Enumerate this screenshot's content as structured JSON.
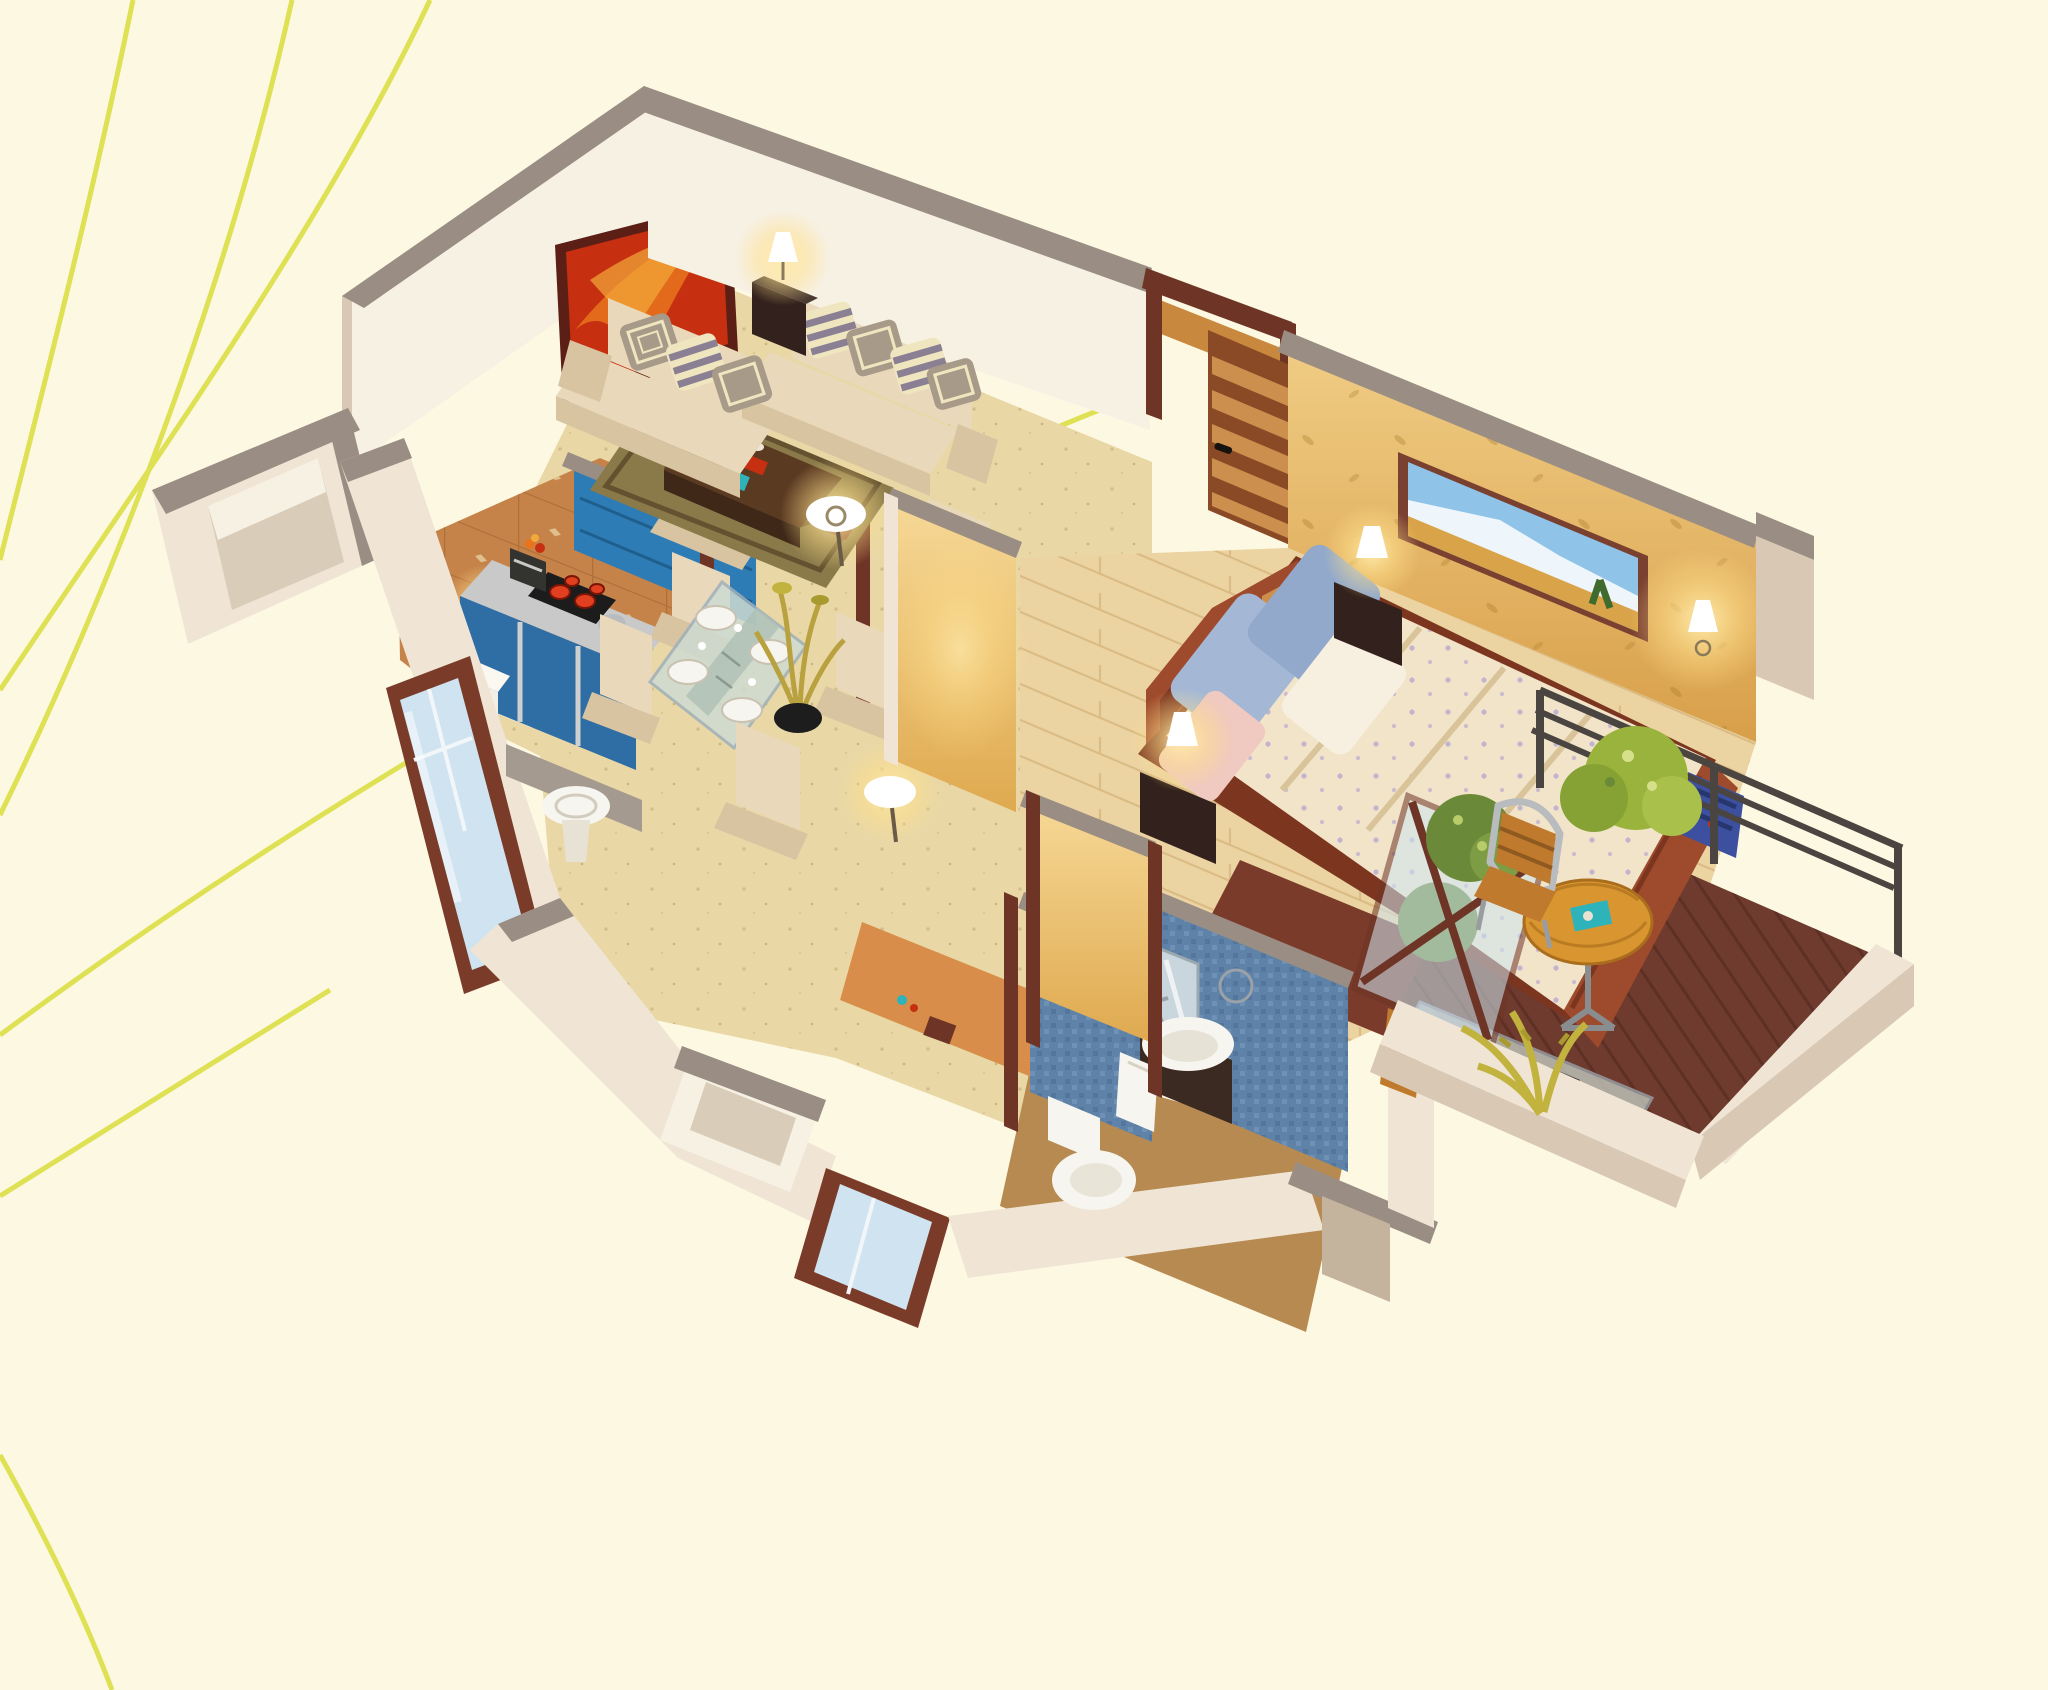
{
  "title": "isometric-1bhk-apartment-cutaway-render",
  "palette": {
    "bg": "#fdf8e2",
    "curve": "#dee153",
    "cap": "#9a8d83",
    "wallLight": "#f0e5d5",
    "wallMid": "#e8dcc8",
    "wallDark": "#d9c9b4",
    "wallInner": "#f7f1e4",
    "floorTravertine": "#e9d8a6",
    "floorKitchen": "#c58349",
    "floorWoodBed": "#ecd3a2",
    "floorBath": "#b78a52",
    "floorBalcony": "#6e3b2e",
    "runnerOrange": "#d88e4a",
    "entryWood": "#c8893f",
    "partitionBlue": "#2e7cb5",
    "cabinetBlue": "#2f6da5",
    "counterSteel": "#c9c9c9",
    "stoveBlack": "#1c1c1c",
    "burnerRed": "#e04020",
    "fridgeWhite": "#f3efe7",
    "windowFrame": "#7a3c28",
    "windowGlass": "#cfe4f0",
    "doorWood": "#8a4a26",
    "doorSlat": "#cd8f4d",
    "frameWood": "#6e3526",
    "sofaCream": "#e9d8ba",
    "sofaShadow": "#d9c4a1",
    "pillowStripe": "#8a7f93",
    "pillowCream": "#efe6c0",
    "pillowTaupe": "#a89a88",
    "rugOlive": "#8a7a4a",
    "rugDark": "#64512f",
    "rugRed": "#7a3b2a",
    "tableWoodTop": "#5b3a22",
    "tableWoodSide": "#3f2817",
    "artRed": "#c62f10",
    "artOrange": "#e8741c",
    "artFrame": "#5c1f16",
    "mtnFrame": "#7a4030",
    "mtnSky": "#8fc4e8",
    "mtnSnow": "#eef6fb",
    "mtnField": "#d9a349",
    "mtnTree": "#3f6b2f",
    "wallYellow": "#e7bb6d",
    "wallYellowDeep": "#dfa94f",
    "bedWood": "#9e4a2c",
    "bedWoodDark": "#7c3620",
    "duvetCream": "#f2e4c9",
    "sheetWhite": "#f7f0e0",
    "pillowBlue": "#a4b8d6",
    "pillowPink": "#f0c9c0",
    "nightstand": "#32211c",
    "lampShade": "#ffffff",
    "mosaicBlue": "#5f83a8",
    "porcelainWhite": "#f7f5ef",
    "vanityDark": "#3a2a22",
    "railMetal": "#4a4540",
    "balconyTable": "#d9952f",
    "chairWood": "#c07a2e",
    "chairSteel": "#b9bcbe",
    "bushGreen": "#6b8a39",
    "bushLight": "#9ab33c",
    "plantYellow": "#c2b23e",
    "backpackBlue": "#3d50a0",
    "glassTint": "#cddbd2",
    "magazineTeal": "#2fb3bb",
    "sillGray": "#a49a90"
  },
  "scene": {
    "type": "isometric-floorplan-render",
    "background_motifs": [
      "curved-line",
      "curved-line",
      "curved-line",
      "curved-line",
      "curved-line",
      "curved-line"
    ],
    "rooms": [
      {
        "name": "living-room",
        "objects": [
          "red-abstract-painting",
          "sofa-three-seat",
          "sofa-two-seat",
          "striped-cushions",
          "corner-lamp-table",
          "table-lamp",
          "coffee-table",
          "magazines",
          "vase",
          "area-rug",
          "armchair",
          "floor-lamp",
          "floor-lamp"
        ]
      },
      {
        "name": "kitchen",
        "objects": [
          "blue-backsplash-partition",
          "wall-disc-lamp",
          "steel-counter",
          "cooktop-four-burners",
          "coffee-maker",
          "fruit-bowl",
          "kettle",
          "blue-cabinets",
          "refrigerator",
          "terracotta-tile-floor",
          "wood-door-frame",
          "window"
        ]
      },
      {
        "name": "dining-area",
        "objects": [
          "glass-dining-table",
          "place-settings",
          "dining-chair",
          "dining-chair",
          "dining-chair",
          "dining-chair",
          "dried-flower-pot",
          "wash-basin",
          "window"
        ]
      },
      {
        "name": "bedroom",
        "objects": [
          "open-wood-door",
          "wardrobe-top",
          "golden-wallpaper",
          "mountain-landscape-painting",
          "wall-lamp",
          "double-bed",
          "checkered-headboard",
          "blue-pillows",
          "white-pillow",
          "pink-pillow",
          "floral-duvet",
          "nightstand",
          "nightstand",
          "bedside-lamp",
          "bedside-lamp",
          "red-rug",
          "blue-backpack",
          "glass-tv-console",
          "wood-chair"
        ]
      },
      {
        "name": "bathroom",
        "objects": [
          "blue-mosaic-walls",
          "mirror",
          "wash-basin-vanity",
          "towel",
          "toilet",
          "decor-plate",
          "orange-runner"
        ]
      },
      {
        "name": "balcony",
        "objects": [
          "dark-wood-deck",
          "metal-railing",
          "glass-wood-partition",
          "round-bistro-table",
          "magazine",
          "slatted-chair",
          "green-bush",
          "green-bush",
          "yellow-plant",
          "white-parapet"
        ]
      }
    ]
  }
}
